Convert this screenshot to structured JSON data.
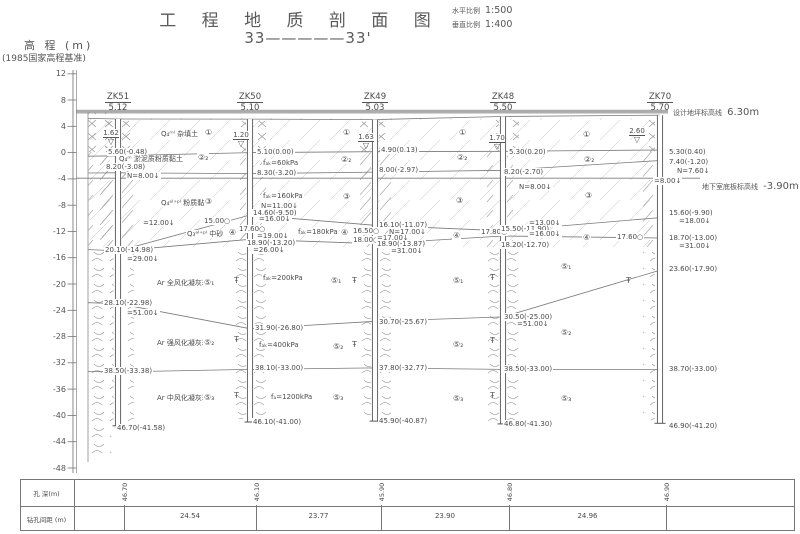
{
  "header": {
    "title": "工 程 地 质 剖 面 图",
    "section_label": "33—————33'",
    "scales": [
      {
        "label": "水平比例",
        "value": "1:500"
      },
      {
        "label": "垂直比例",
        "value": "1:400"
      }
    ]
  },
  "axis": {
    "title": "高 程 (m)",
    "datum": "(1985国家高程基准)",
    "ticks": [
      12,
      8,
      4,
      0,
      -4,
      -8,
      -12,
      -16,
      -20,
      -24,
      -28,
      -32,
      -36,
      -40,
      -44,
      -48
    ]
  },
  "ref_lines": {
    "design_ground": {
      "label": "设计地坪标高线",
      "value": "6.30m",
      "elev": 6.3
    },
    "basement_floor": {
      "label": "地下室底板标高线",
      "value": "-3.90m",
      "elev": -3.9
    }
  },
  "boreholes": [
    {
      "id": "ZK51",
      "top_label": "5.12",
      "x": 118,
      "top": 5.12,
      "bottom": -41.58,
      "depth_m": "46.70"
    },
    {
      "id": "ZK50",
      "top_label": "5.10",
      "x": 250,
      "top": 5.1,
      "bottom": -41.0,
      "depth_m": "46.10"
    },
    {
      "id": "ZK49",
      "top_label": "5.03",
      "x": 375,
      "top": 5.03,
      "bottom": -40.87,
      "depth_m": "45.90"
    },
    {
      "id": "ZK48",
      "top_label": "5.50",
      "x": 503,
      "top": 5.5,
      "bottom": -41.3,
      "depth_m": "46.80"
    },
    {
      "id": "ZK70",
      "top_label": "5.70",
      "x": 660,
      "top": 5.7,
      "bottom": -41.2,
      "depth_m": "46.90"
    }
  ],
  "water_levels": [
    {
      "v": "1.62",
      "x": 98,
      "y": 120
    },
    {
      "v": "1.20",
      "x": 228,
      "y": 122
    },
    {
      "v": "1.63",
      "x": 353,
      "y": 124
    },
    {
      "v": "1.70",
      "x": 484,
      "y": 125
    },
    {
      "v": "2.60",
      "x": 624,
      "y": 118
    }
  ],
  "strata_boundaries": [
    {
      "name": "ground-surface",
      "pts": [
        [
          88,
          5.2
        ],
        [
          118,
          5.12
        ],
        [
          250,
          5.1
        ],
        [
          375,
          5.03
        ],
        [
          503,
          5.5
        ],
        [
          660,
          5.7
        ]
      ]
    },
    {
      "name": "fill-bottom",
      "pts": [
        [
          88,
          -0.55
        ],
        [
          118,
          -0.48
        ],
        [
          250,
          0.0
        ],
        [
          375,
          0.13
        ],
        [
          503,
          0.2
        ],
        [
          660,
          0.4
        ]
      ]
    },
    {
      "name": "mud-clay-bottom",
      "pts": [
        [
          88,
          -3.1
        ],
        [
          118,
          -3.08
        ],
        [
          250,
          -3.2
        ],
        [
          375,
          -2.97
        ],
        [
          503,
          -2.7
        ],
        [
          660,
          -1.2
        ]
      ]
    },
    {
      "name": "sand-top",
      "pts": [
        [
          118,
          -14.98
        ],
        [
          250,
          -9.5
        ],
        [
          375,
          -11.07
        ],
        [
          503,
          -11.9
        ],
        [
          660,
          -9.9
        ]
      ]
    },
    {
      "name": "sand-bottom",
      "pts": [
        [
          88,
          -14.75
        ],
        [
          118,
          -14.98
        ],
        [
          250,
          -13.2
        ],
        [
          375,
          -13.87
        ],
        [
          503,
          -12.7
        ],
        [
          660,
          -13.0
        ]
      ]
    },
    {
      "name": "w1-bottom",
      "pts": [
        [
          88,
          -22.85
        ],
        [
          118,
          -22.98
        ],
        [
          250,
          -26.8
        ],
        [
          375,
          -25.67
        ],
        [
          503,
          -25.0
        ],
        [
          660,
          -17.9
        ]
      ]
    },
    {
      "name": "w2-bottom",
      "pts": [
        [
          88,
          -33.3
        ],
        [
          118,
          -33.38
        ],
        [
          250,
          -33.0
        ],
        [
          375,
          -32.77
        ],
        [
          503,
          -33.0
        ],
        [
          660,
          -33.0
        ]
      ]
    }
  ],
  "labels": [
    {
      "t": "5.60(-0.48)",
      "x": 107,
      "y": 148
    },
    {
      "t": "8.20(-3.08)",
      "x": 105,
      "y": 163
    },
    {
      "t": "N=8.00↓",
      "x": 126,
      "y": 172
    },
    {
      "t": "=12.00↓",
      "x": 142,
      "y": 219
    },
    {
      "t": "20.10(-14.98)",
      "x": 104,
      "y": 246
    },
    {
      "t": "=29.00↓",
      "x": 126,
      "y": 255
    },
    {
      "t": "28.10(-22.98)",
      "x": 103,
      "y": 299
    },
    {
      "t": "=51.00↓",
      "x": 126,
      "y": 309
    },
    {
      "t": "38.50(-33.38)",
      "x": 103,
      "y": 367
    },
    {
      "t": "46.70(-41.58)",
      "x": 116,
      "y": 424
    },
    {
      "t": "Q₄ᵐˡ 杂填土",
      "x": 160,
      "y": 130
    },
    {
      "t": "①",
      "x": 204,
      "y": 128,
      "c": 1
    },
    {
      "t": "Q₄ᵐ 淤泥质粉质黏土",
      "x": 118,
      "y": 155
    },
    {
      "t": "②₂",
      "x": 197,
      "y": 153,
      "c": 1
    },
    {
      "t": "Q₄ᵃˡ⁺ᵖˡ 粉质黏土",
      "x": 160,
      "y": 199
    },
    {
      "t": "③",
      "x": 204,
      "y": 197,
      "c": 1
    },
    {
      "t": "15.00○",
      "x": 203,
      "y": 217
    },
    {
      "t": "Q₃ᵃˡ⁺ᵖˡ 中砂",
      "x": 186,
      "y": 230
    },
    {
      "t": "④",
      "x": 228,
      "y": 228,
      "c": 1
    },
    {
      "t": "17.60○",
      "x": 238,
      "y": 225
    },
    {
      "t": "Ar 全风化凝灰岩",
      "x": 156,
      "y": 279
    },
    {
      "t": "⑤₁",
      "x": 203,
      "y": 278,
      "c": 1
    },
    {
      "t": "Ar 强风化凝灰岩",
      "x": 156,
      "y": 339
    },
    {
      "t": "⑤₂",
      "x": 203,
      "y": 338,
      "c": 1
    },
    {
      "t": "Ar 中风化凝灰岩",
      "x": 156,
      "y": 394
    },
    {
      "t": "⑤₃",
      "x": 203,
      "y": 393,
      "c": 1
    },
    {
      "t": "5.10(0.00)",
      "x": 256,
      "y": 148
    },
    {
      "t": "fₐₖ=60kPa",
      "x": 262,
      "y": 159
    },
    {
      "t": "8.30(-3.20)",
      "x": 256,
      "y": 169
    },
    {
      "t": "fₐₖ=160kPa",
      "x": 262,
      "y": 192
    },
    {
      "t": "N=11.00↓",
      "x": 260,
      "y": 202
    },
    {
      "t": "14.60(-9.50)",
      "x": 252,
      "y": 209
    },
    {
      "t": "=16.00↓",
      "x": 258,
      "y": 215
    },
    {
      "t": "fₐₖ=180kPa",
      "x": 297,
      "y": 228
    },
    {
      "t": "④",
      "x": 340,
      "y": 228,
      "c": 1
    },
    {
      "t": "16.50○",
      "x": 352,
      "y": 227
    },
    {
      "t": "18.00○",
      "x": 352,
      "y": 236
    },
    {
      "t": "=19.00↓",
      "x": 256,
      "y": 232
    },
    {
      "t": "18.90(-13.20)",
      "x": 246,
      "y": 239
    },
    {
      "t": "=26.00↓",
      "x": 252,
      "y": 246
    },
    {
      "t": "fₐₖ=200kPa",
      "x": 262,
      "y": 274
    },
    {
      "t": "⑤₁",
      "x": 330,
      "y": 276,
      "c": 1
    },
    {
      "t": "31.90(-26.80)",
      "x": 254,
      "y": 324
    },
    {
      "t": "fₐₖ=400kPa",
      "x": 258,
      "y": 341
    },
    {
      "t": "⑤₂",
      "x": 332,
      "y": 342,
      "c": 1
    },
    {
      "t": "38.10(-33.00)",
      "x": 254,
      "y": 364
    },
    {
      "t": "fₐ=1200kPa",
      "x": 270,
      "y": 393
    },
    {
      "t": "⑤₃",
      "x": 332,
      "y": 393,
      "c": 1
    },
    {
      "t": "46.10(-41.00)",
      "x": 252,
      "y": 418
    },
    {
      "t": "①",
      "x": 342,
      "y": 128,
      "c": 1
    },
    {
      "t": "②₂",
      "x": 340,
      "y": 155,
      "c": 1
    },
    {
      "t": "③",
      "x": 342,
      "y": 192,
      "c": 1
    },
    {
      "t": "4.90(0.13)",
      "x": 380,
      "y": 146
    },
    {
      "t": "8.00(-2.97)",
      "x": 378,
      "y": 166
    },
    {
      "t": "16.10(-11.07)",
      "x": 378,
      "y": 221
    },
    {
      "t": "N=17.00↓",
      "x": 388,
      "y": 228
    },
    {
      "t": "=17.00↓",
      "x": 376,
      "y": 234
    },
    {
      "t": "18.90(-13.87)",
      "x": 376,
      "y": 240
    },
    {
      "t": "=31.00↓",
      "x": 390,
      "y": 247
    },
    {
      "t": "17.80○",
      "x": 480,
      "y": 228
    },
    {
      "t": "30.70(-25.67)",
      "x": 378,
      "y": 318
    },
    {
      "t": "37.80(-32.77)",
      "x": 378,
      "y": 364
    },
    {
      "t": "45.90(-40.87)",
      "x": 378,
      "y": 417
    },
    {
      "t": "①",
      "x": 458,
      "y": 128,
      "c": 1
    },
    {
      "t": "②₂",
      "x": 456,
      "y": 153,
      "c": 1
    },
    {
      "t": "③",
      "x": 455,
      "y": 196,
      "c": 1
    },
    {
      "t": "④",
      "x": 452,
      "y": 231,
      "c": 1
    },
    {
      "t": "⑤₁",
      "x": 452,
      "y": 276,
      "c": 1
    },
    {
      "t": "⑤₂",
      "x": 452,
      "y": 340,
      "c": 1
    },
    {
      "t": "⑤₃",
      "x": 452,
      "y": 394,
      "c": 1
    },
    {
      "t": "5.30(0.20)",
      "x": 508,
      "y": 148
    },
    {
      "t": "8.20(-2.70)",
      "x": 503,
      "y": 168
    },
    {
      "t": "N=8.00↓",
      "x": 518,
      "y": 183
    },
    {
      "t": "=13.00↓",
      "x": 528,
      "y": 219
    },
    {
      "t": "15.50(-11.90)",
      "x": 500,
      "y": 225
    },
    {
      "t": "=16.00↓",
      "x": 528,
      "y": 230
    },
    {
      "t": "17.60○",
      "x": 616,
      "y": 233
    },
    {
      "t": "18.20(-12.70)",
      "x": 500,
      "y": 241
    },
    {
      "t": "30.50(-25.00)",
      "x": 503,
      "y": 313
    },
    {
      "t": "=51.00↓",
      "x": 516,
      "y": 320
    },
    {
      "t": "38.50(-33.00)",
      "x": 503,
      "y": 365
    },
    {
      "t": "46.80(-41.30)",
      "x": 503,
      "y": 420
    },
    {
      "t": "①",
      "x": 582,
      "y": 130,
      "c": 1
    },
    {
      "t": "②₂",
      "x": 583,
      "y": 155,
      "c": 1
    },
    {
      "t": "③",
      "x": 584,
      "y": 191,
      "c": 1
    },
    {
      "t": "④",
      "x": 582,
      "y": 233,
      "c": 1
    },
    {
      "t": "⑤₁",
      "x": 560,
      "y": 262,
      "c": 1
    },
    {
      "t": "⑤₂",
      "x": 560,
      "y": 328,
      "c": 1
    },
    {
      "t": "⑤₃",
      "x": 560,
      "y": 394,
      "c": 1
    },
    {
      "t": "5.30(0.40)",
      "x": 668,
      "y": 148
    },
    {
      "t": "7.40(-1.20)",
      "x": 668,
      "y": 158
    },
    {
      "t": "N=7.60↓",
      "x": 676,
      "y": 167
    },
    {
      "t": "=8.00↓",
      "x": 653,
      "y": 177
    },
    {
      "t": "15.60(-9.90)",
      "x": 668,
      "y": 209
    },
    {
      "t": "=18.00↓",
      "x": 678,
      "y": 217
    },
    {
      "t": "18.70(-13.00)",
      "x": 668,
      "y": 234
    },
    {
      "t": "=31.00↓",
      "x": 678,
      "y": 242
    },
    {
      "t": "23.60(-17.90)",
      "x": 668,
      "y": 265
    },
    {
      "t": "38.70(-33.00)",
      "x": 668,
      "y": 365
    },
    {
      "t": "46.90(-41.20)",
      "x": 668,
      "y": 422
    }
  ],
  "markers": [
    {
      "x": 234,
      "y": 277
    },
    {
      "x": 234,
      "y": 336
    },
    {
      "x": 234,
      "y": 392
    },
    {
      "x": 352,
      "y": 277
    },
    {
      "x": 352,
      "y": 341
    },
    {
      "x": 490,
      "y": 274
    },
    {
      "x": 490,
      "y": 337
    },
    {
      "x": 490,
      "y": 392
    },
    {
      "x": 626,
      "y": 277
    }
  ],
  "table": {
    "row1_label": "孔  深(m)",
    "row2_label": "钻孔间距 (m)",
    "spacings": [
      "24.54",
      "23.77",
      "23.90",
      "24.96"
    ]
  }
}
